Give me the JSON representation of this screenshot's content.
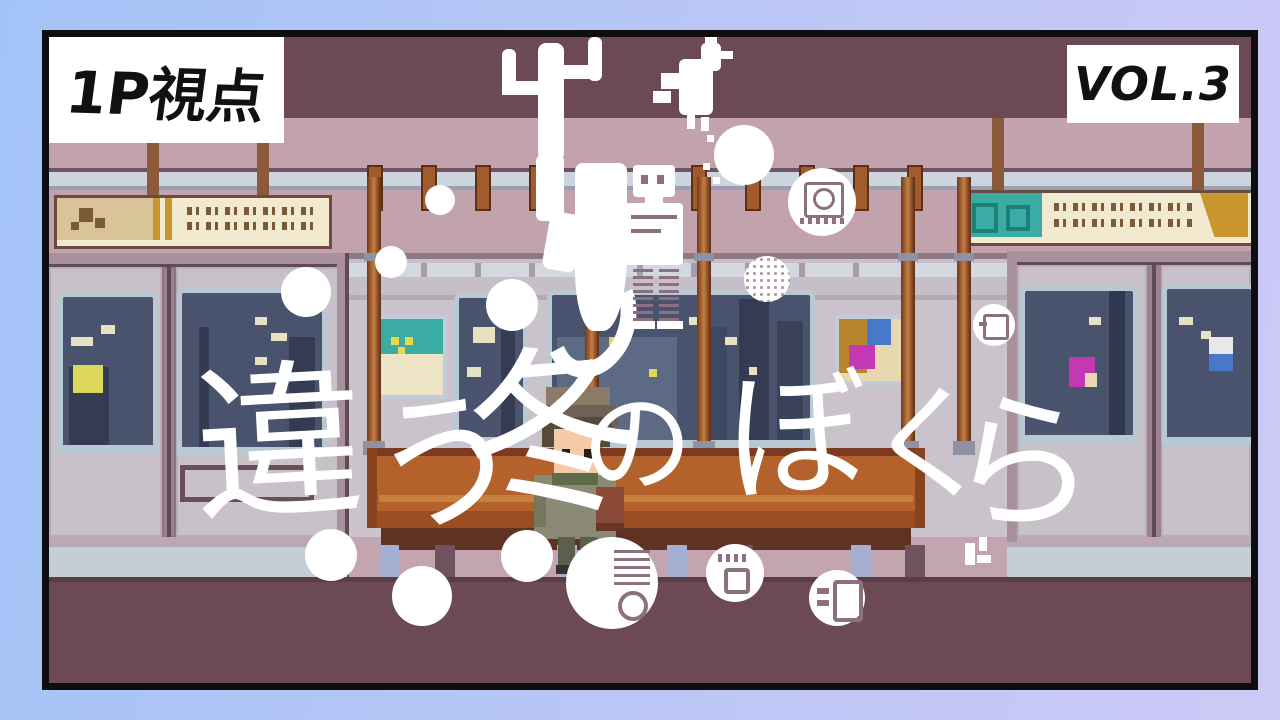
{
  "badges": {
    "viewpoint": "1P視点",
    "volume": "VOL.3"
  },
  "title": {
    "full": "違う冬のぼくら",
    "chars": [
      "違",
      "う",
      "冬",
      "の",
      "ぼ",
      "く",
      "ら"
    ]
  },
  "colors": {
    "frame_gradient_start": "#a3c3f7",
    "frame_gradient_end": "#cdc9f6",
    "frame_line": "#0e0e10",
    "wall": "#cac3cc",
    "band_dark": "#6b4a53",
    "band_pink": "#c2a2ad",
    "rail_light": "#ccd4de",
    "luggage_band": "#c6bfc8",
    "window_glass": "#49536e",
    "window_frame": "#b9c9d2",
    "building_dark": "#343b52",
    "lit_yellow": "#dcd75a",
    "lit_cream": "#e6e2c2",
    "bench": "#b4622c",
    "bench_light": "#c8803f",
    "bench_shade": "#9a4e22",
    "bench_base": "#5e3322",
    "pole": "#a9622f",
    "floor": "#6b4a53",
    "strip_pink": "#c3a5b0",
    "strip_blue": "#c3ced6",
    "banner_cream": "#f2ead0",
    "banner_tan": "#d9c49a",
    "banner_teal": "#3aaca4",
    "banner_gold": "#c9962e",
    "poster_teal": "#3aaca4",
    "poster_magenta": "#c438b4",
    "poster_blue": "#4a78c8",
    "poster_gold": "#b8862e",
    "snow": "#ffffff",
    "badge_bg": "#ffffff",
    "badge_text": "#111111",
    "title_color": "#ffffff"
  },
  "decorations": [
    "cactus-icon",
    "ribbon-icon",
    "rooster-icon",
    "robot-icon",
    "washing-machine-icon",
    "dotted-circle-icon",
    "gear-circle-icon",
    "half-machine-circle-icon",
    "snow-dot"
  ]
}
